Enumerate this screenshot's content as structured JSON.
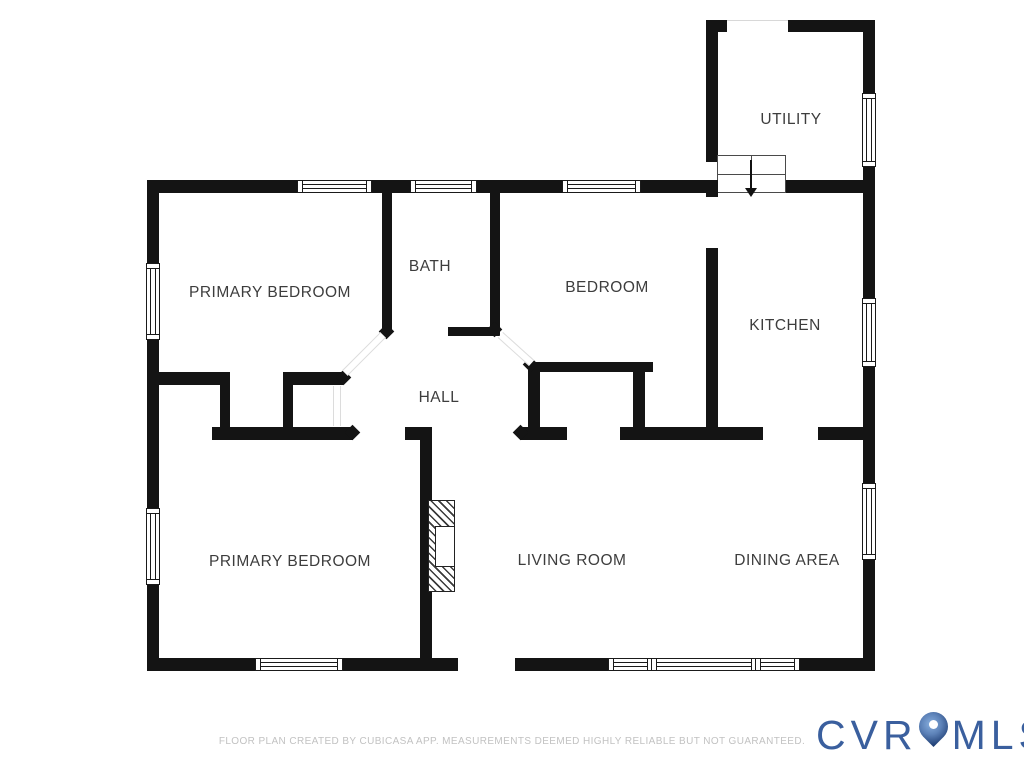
{
  "floor_plan": {
    "rooms": [
      {
        "label": "UTILITY"
      },
      {
        "label": "PRIMARY BEDROOM"
      },
      {
        "label": "BATH"
      },
      {
        "label": "BEDROOM"
      },
      {
        "label": "KITCHEN"
      },
      {
        "label": "HALL"
      },
      {
        "label": "PRIMARY BEDROOM"
      },
      {
        "label": "LIVING ROOM"
      },
      {
        "label": "DINING AREA"
      }
    ]
  },
  "footer": {
    "disclaimer": "FLOOR PLAN CREATED BY CUBICASA APP. MEASUREMENTS DEEMED HIGHLY RELIABLE BUT NOT GUARANTEED."
  },
  "logo": {
    "text_left": "CVR",
    "text_right": "MLS",
    "pin_icon": "map-pin-icon"
  },
  "colors": {
    "wall": "#141414",
    "label": "#3d3d3d",
    "disclaimer": "#c2c2c2",
    "logo_blue": "#3a5f9e",
    "pin_dark": "#1d3c72",
    "pin_light": "#87aede"
  }
}
